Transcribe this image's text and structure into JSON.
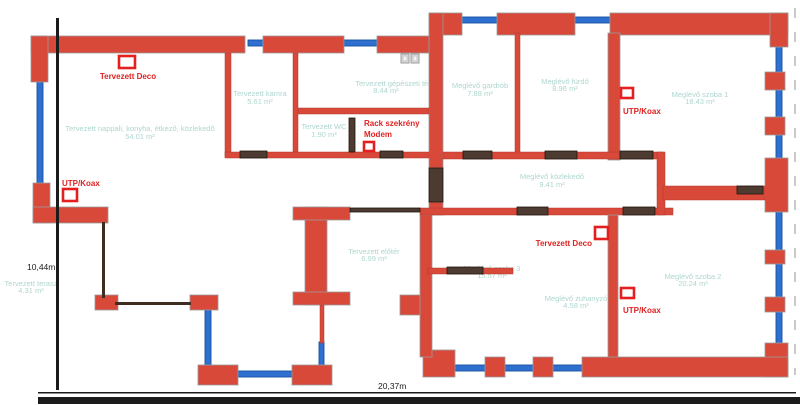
{
  "plan": {
    "type": "floor-plan",
    "colors": {
      "wall": "#d8493a",
      "window": "#2e6fd0",
      "door": "#4d3b31",
      "room_label": "#aed6cf",
      "annotation": "#e02222",
      "marker_outline": "#e41f1f",
      "dimension": "#1b1b1b"
    },
    "icons": {
      "fixture_a": "small-square-fixture-symbol",
      "fixture_b": "small-square-fixture-symbol"
    }
  },
  "rooms": {
    "nappali": {
      "name": "Tervezett nappali, konyha, étkező, közlekedő",
      "area": "54.01 m²"
    },
    "kamra": {
      "name": "Tervezett kamra",
      "area": "5.61 m²"
    },
    "gepeszeti": {
      "name": "Tervezett gépészeti tér",
      "area": "8.44 m²"
    },
    "wc": {
      "name": "Tervezett WC",
      "area": "1.90 m²"
    },
    "terasz": {
      "name": "Tervezett terasz",
      "area": "4.31 m²"
    },
    "eloter": {
      "name": "Tervezett előtér",
      "area": "6.99 m²"
    },
    "gardrob": {
      "name": "Meglévő gardrób",
      "area": "7.88 m²"
    },
    "furdo": {
      "name": "Meglévő fürdő",
      "area": "8.96 m²"
    },
    "szoba1": {
      "name": "Meglévő szoba 1",
      "area": "18.43 m²"
    },
    "kozlekedo": {
      "name": "Meglévő közlekedő",
      "area": "9.41 m²"
    },
    "szoba3": {
      "name": "Meglévő szoba 3",
      "area": "15.57 m²"
    },
    "zuhanyzo": {
      "name": "Meglévő zuhanyzó",
      "area": "4.58 m²"
    },
    "szoba2": {
      "name": "Meglévő szoba 2",
      "area": "20.24 m²"
    }
  },
  "annotations": {
    "deco1": "Tervezett Deco",
    "deco2": "Tervezett Deco",
    "utp1": "UTP/Koax",
    "utp2": "UTP/Koax",
    "utp3": "UTP/Koax",
    "rack_line1": "Rack szekrény",
    "rack_line2": "Modem"
  },
  "dimensions": {
    "height": "10,44m",
    "width": "20,37m"
  }
}
